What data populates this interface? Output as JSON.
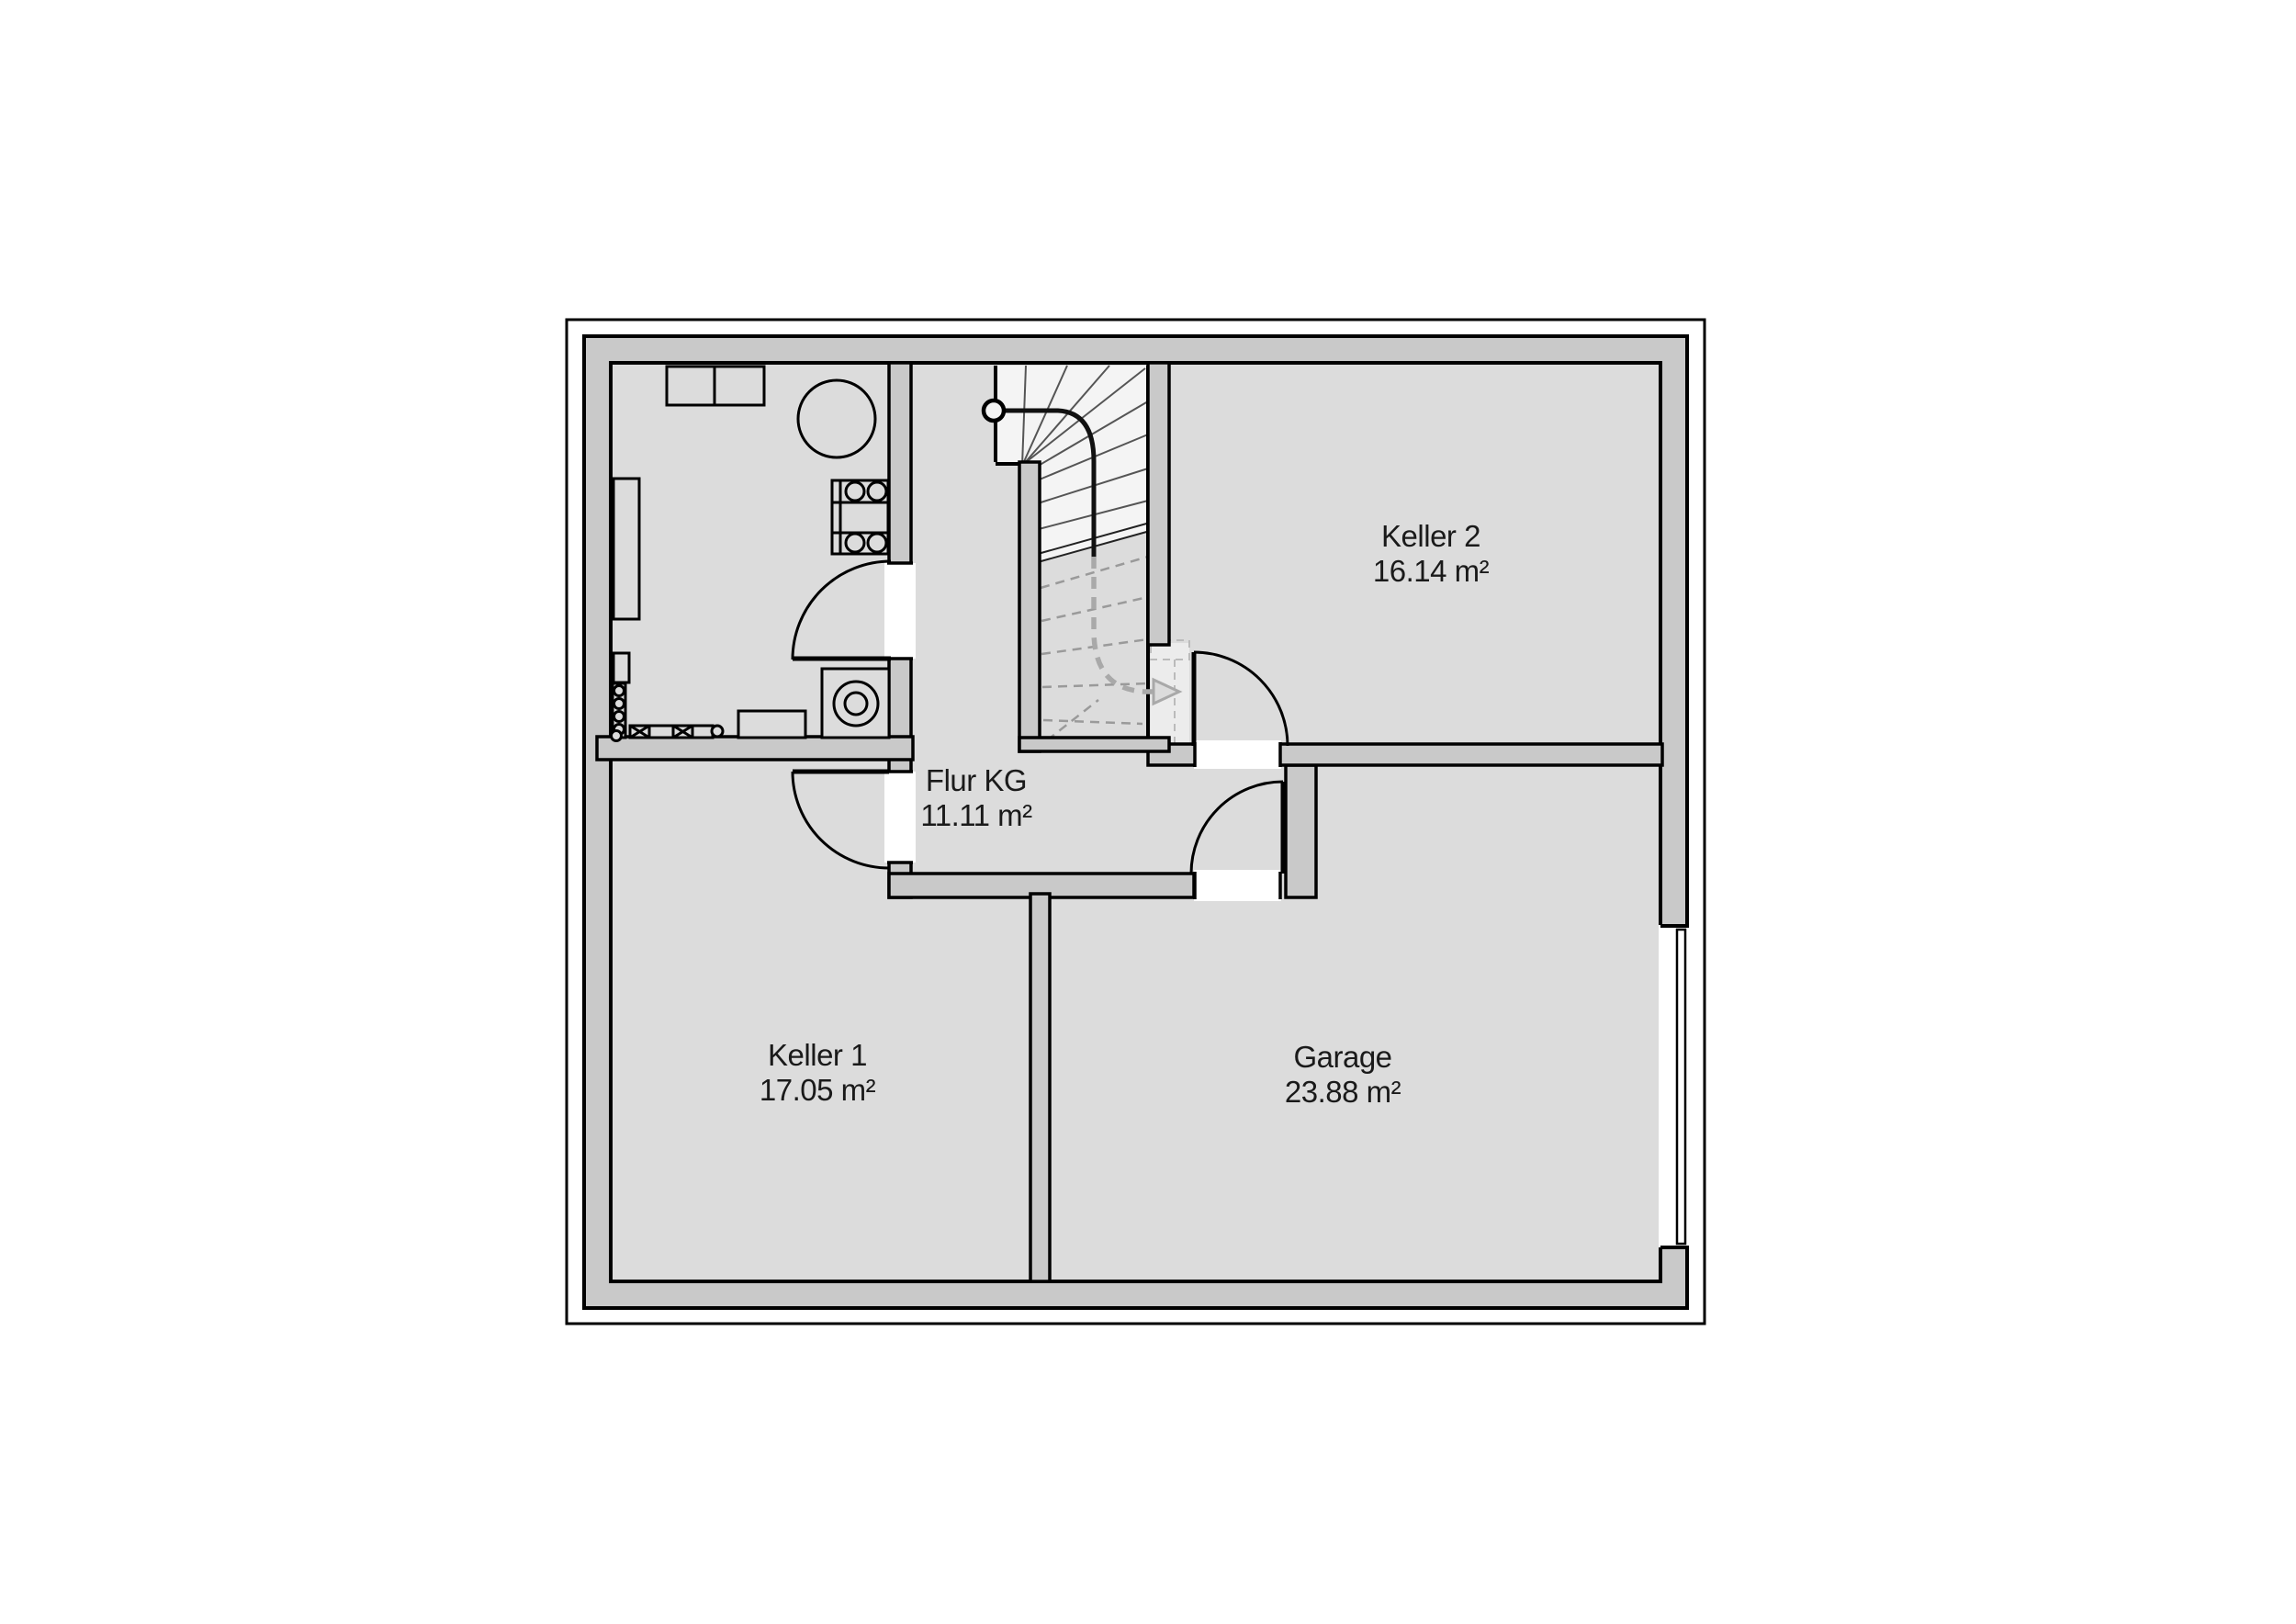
{
  "document": {
    "type": "floor-plan",
    "level": "Kellergeschoss (basement)"
  },
  "colors": {
    "background": "#ffffff",
    "floor": "#dcdcdc",
    "wall_fill": "#c9c9c9",
    "outline": "#000000",
    "stair_upper_fill": "#f4f4f4",
    "threshold_fill": "#ececec",
    "walkline_gray": "#a9a9a9",
    "tread_line": "#555555",
    "text": "#1a1a1a"
  },
  "rooms": [
    {
      "id": "keller2",
      "name": "Keller 2",
      "area": "16.14 m²"
    },
    {
      "id": "flur-kg",
      "name": "Flur KG",
      "area": "11.11 m²"
    },
    {
      "id": "keller1",
      "name": "Keller 1",
      "area": "17.05 m²"
    },
    {
      "id": "garage",
      "name": "Garage",
      "area": "23.88 m²"
    }
  ],
  "fixtures": [
    "wall-cabinet",
    "round-tank",
    "hotplate-unit",
    "tall-shelf",
    "pipe-radiator",
    "workbench-row",
    "bench",
    "washing-machine",
    "winder-staircase",
    "stair-walk-line",
    "garage-sectional-door"
  ],
  "doors": [
    "utility-room-door",
    "keller1-door",
    "keller2-door",
    "garage-corridor-door",
    "garage-exterior-door"
  ]
}
